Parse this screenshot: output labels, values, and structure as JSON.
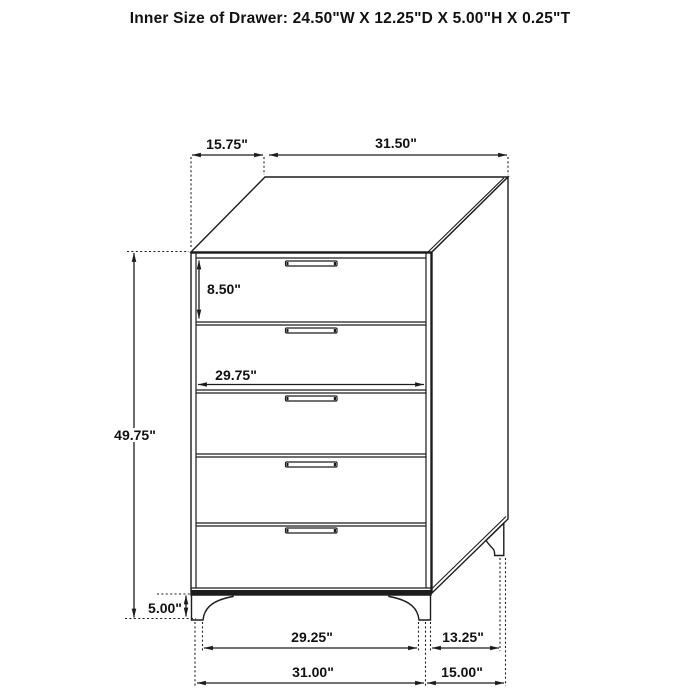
{
  "title": "Inner Size of Drawer: 24.50\"W X 12.25\"D X 5.00\"H X 0.25\"T",
  "dims": {
    "top_depth": "15.75\"",
    "top_width": "31.50\"",
    "overall_height": "49.75\"",
    "drawer_front_height": "8.50\"",
    "drawer_opening_width": "29.75\"",
    "leg_height": "5.00\"",
    "front_legs_inner_span": "29.25\"",
    "side_legs_inner_span": "13.25\"",
    "overall_width": "31.00\"",
    "overall_depth": "15.00\""
  },
  "colors": {
    "line": "#1c1c1c",
    "background": "#ffffff"
  }
}
